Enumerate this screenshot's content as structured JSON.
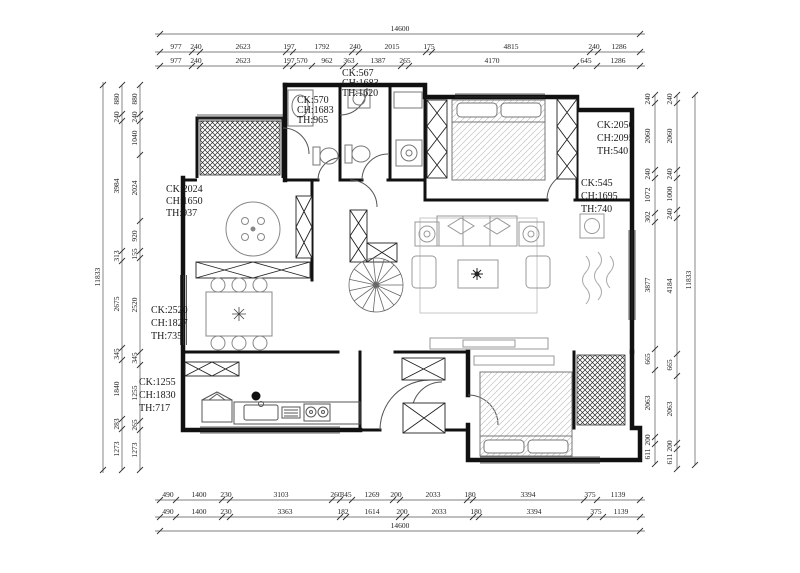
{
  "dims": {
    "top": {
      "total": "14600",
      "row1": [
        "977",
        "240",
        "2623",
        "197",
        "1792",
        "240",
        "2015",
        "175",
        "4815",
        "240",
        "1286"
      ],
      "row2": [
        "977",
        "240",
        "2623",
        "197",
        "570",
        "962",
        "363",
        "1387",
        "265",
        "4170",
        "645",
        "1286"
      ]
    },
    "bottom": {
      "total": "14600",
      "row1": [
        "490",
        "1400",
        "230",
        "3103",
        "260",
        "345",
        "1269",
        "200",
        "2033",
        "180",
        "3394",
        "375",
        "1139"
      ],
      "row2": [
        "490",
        "1400",
        "230",
        "3363",
        "182",
        "1614",
        "200",
        "2033",
        "180",
        "3394",
        "375",
        "1139"
      ]
    },
    "left": {
      "total": "11833",
      "outer": [
        "880",
        "240",
        "3984",
        "313",
        "2675",
        "345",
        "1840",
        "283",
        "1273"
      ],
      "inner": [
        "880",
        "240",
        "1040",
        "2024",
        "920",
        "155",
        "2520",
        "345",
        "1255",
        "265",
        "1273"
      ]
    },
    "right": {
      "total": "11833",
      "inner": [
        "240",
        "2060",
        "240",
        "1072",
        "302",
        "3877",
        "665",
        "2063",
        "200",
        "611"
      ],
      "outer": [
        "240",
        "2060",
        "240",
        "1000",
        "240",
        "4184",
        "665",
        "2063",
        "200",
        "611"
      ]
    }
  },
  "rooms": [
    {
      "ck": "CK:570",
      "ch": "CH:1683",
      "th": "TH:965"
    },
    {
      "ck": "CK:567",
      "ch": "CH:1683",
      "th": "TH:1620"
    },
    {
      "ck": "CK:2050",
      "ch": "CH:2095",
      "th": "TH:540"
    },
    {
      "ck": "CK:545",
      "ch": "CH:1695",
      "th": "TH:740"
    },
    {
      "ck": "CK:2024",
      "ch": "CH:1650",
      "th": "TH:937"
    },
    {
      "ck": "CK:2520",
      "ch": "CH:1827",
      "th": "TH:735"
    },
    {
      "ck": "CK:1255",
      "ch": "CH:1830",
      "th": "TH:717"
    }
  ],
  "colors": {
    "ink": "#1a1a1a",
    "dim_line": "#444",
    "furniture": "#888"
  }
}
